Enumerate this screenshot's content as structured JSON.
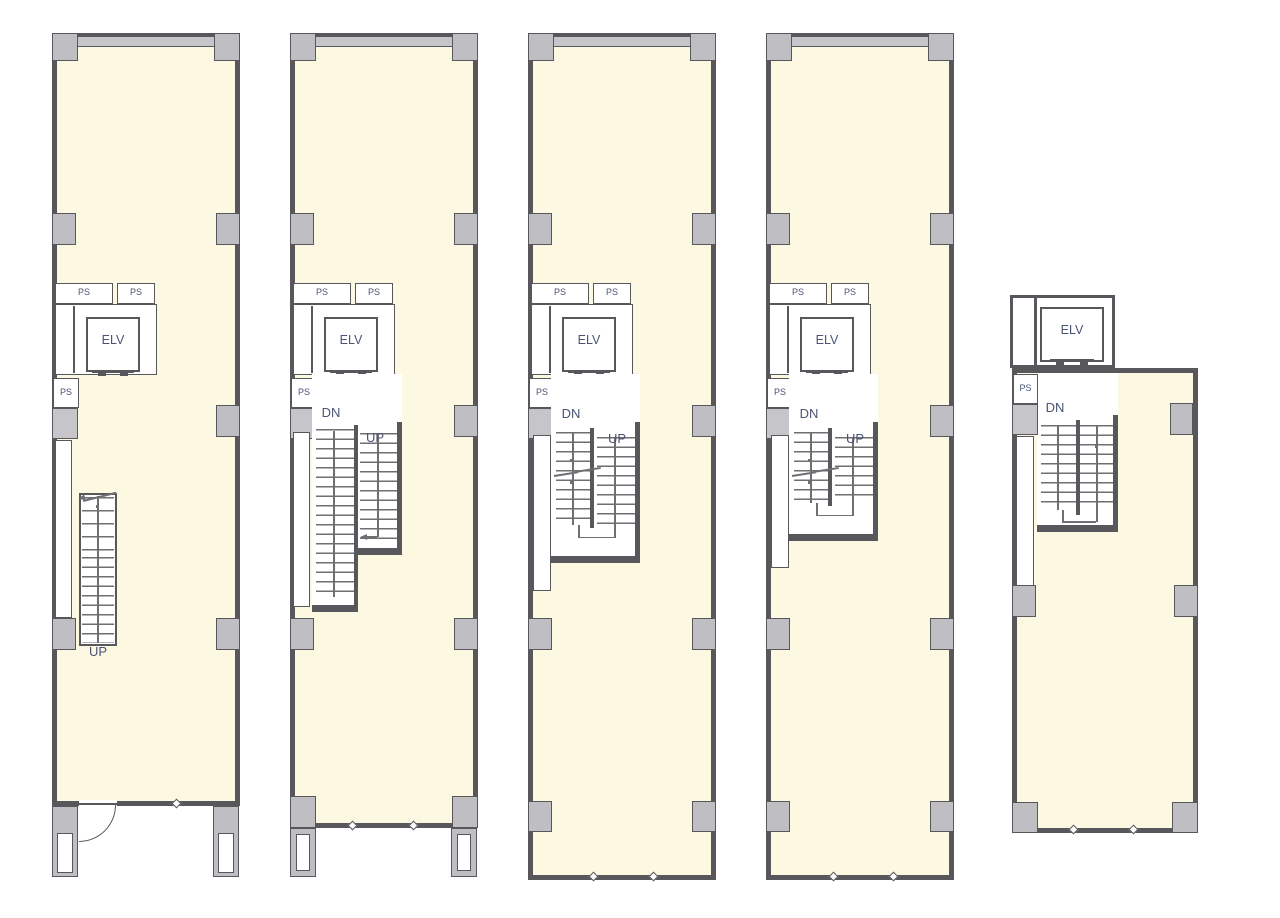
{
  "sheet": {
    "background": "#ffffff"
  },
  "colors": {
    "floor_fill": "#fcf8e2",
    "wall": "#57575c",
    "column_fill": "#bfbfc3",
    "band_fill": "#c6c6ca",
    "text": "#4a5374",
    "tread": "#6e6e73"
  },
  "plans": [
    {
      "id": "floor-plan-1",
      "labels": {
        "ps_top_1": "PS",
        "ps_top_2": "PS",
        "ps_side": "PS",
        "elevator": "ELV",
        "up": "UP"
      }
    },
    {
      "id": "floor-plan-2",
      "labels": {
        "ps_top_1": "PS",
        "ps_top_2": "PS",
        "ps_side": "PS",
        "elevator": "ELV",
        "down": "DN",
        "up": "UP"
      }
    },
    {
      "id": "floor-plan-3",
      "labels": {
        "ps_top_1": "PS",
        "ps_top_2": "PS",
        "ps_side": "PS",
        "elevator": "ELV",
        "down": "DN",
        "up": "UP"
      }
    },
    {
      "id": "floor-plan-4",
      "labels": {
        "ps_top_1": "PS",
        "ps_top_2": "PS",
        "ps_side": "PS",
        "elevator": "ELV",
        "down": "DN",
        "up": "UP"
      }
    },
    {
      "id": "floor-plan-5",
      "labels": {
        "ps_side": "PS",
        "elevator": "ELV",
        "down": "DN"
      }
    }
  ]
}
